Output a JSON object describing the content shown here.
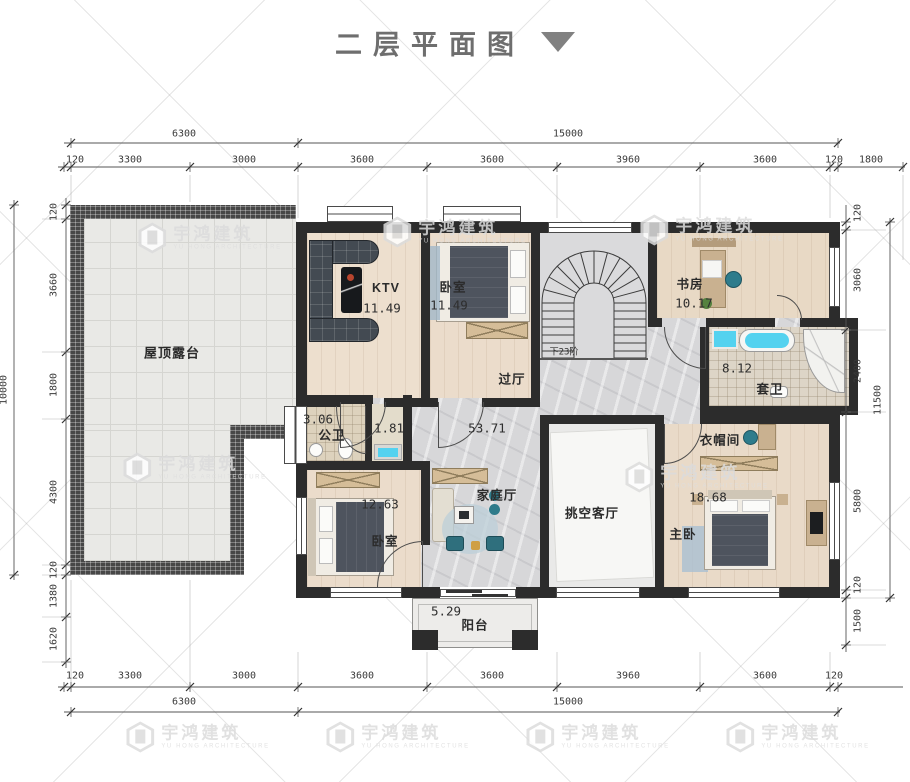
{
  "title": {
    "text": "二层平面图"
  },
  "watermark": {
    "cn": "宇鸿建筑",
    "en": "YU HONG ARCHITECTURE"
  },
  "rooms": {
    "terrace": {
      "name": "屋顶露台"
    },
    "ktv": {
      "name": "KTV",
      "area": "11.49"
    },
    "bedroom_top": {
      "name": "卧室",
      "area": "11.49"
    },
    "study": {
      "name": "书房",
      "area": "10.17"
    },
    "ensuite": {
      "name": "套卫",
      "area": "8.12"
    },
    "hall": {
      "name": "过厅",
      "area": "53.71"
    },
    "public_bath": {
      "name": "公卫",
      "area": "3.06"
    },
    "wash": {
      "area": "1.81"
    },
    "family": {
      "name": "家庭厅"
    },
    "void_living": {
      "name": "挑空客厅"
    },
    "bedroom_bottom": {
      "name": "卧室",
      "area": "12.63"
    },
    "master": {
      "name": "主卧",
      "area": "18.68"
    },
    "cloak": {
      "name": "衣帽间"
    },
    "balcony": {
      "name": "阳台",
      "area": "5.29"
    },
    "stairs": {
      "note": "下23阶"
    }
  },
  "dims": {
    "top_overall": [
      "6300",
      "15000"
    ],
    "top_detail": [
      "120",
      "3300",
      "3000",
      "3600",
      "3600",
      "3960",
      "3600",
      "120",
      "1800"
    ],
    "bottom_detail": [
      "120",
      "3300",
      "3000",
      "3600",
      "3600",
      "3960",
      "3600",
      "120"
    ],
    "bottom_overall": [
      "6300",
      "15000"
    ],
    "left_detail": [
      "120",
      "3660",
      "1800",
      "4300",
      "120",
      "1380",
      "1620"
    ],
    "left_overall": "10000",
    "right_detail": [
      "120",
      "3060",
      "2400",
      "5800",
      "120",
      "1500"
    ],
    "right_overall": "11500"
  }
}
